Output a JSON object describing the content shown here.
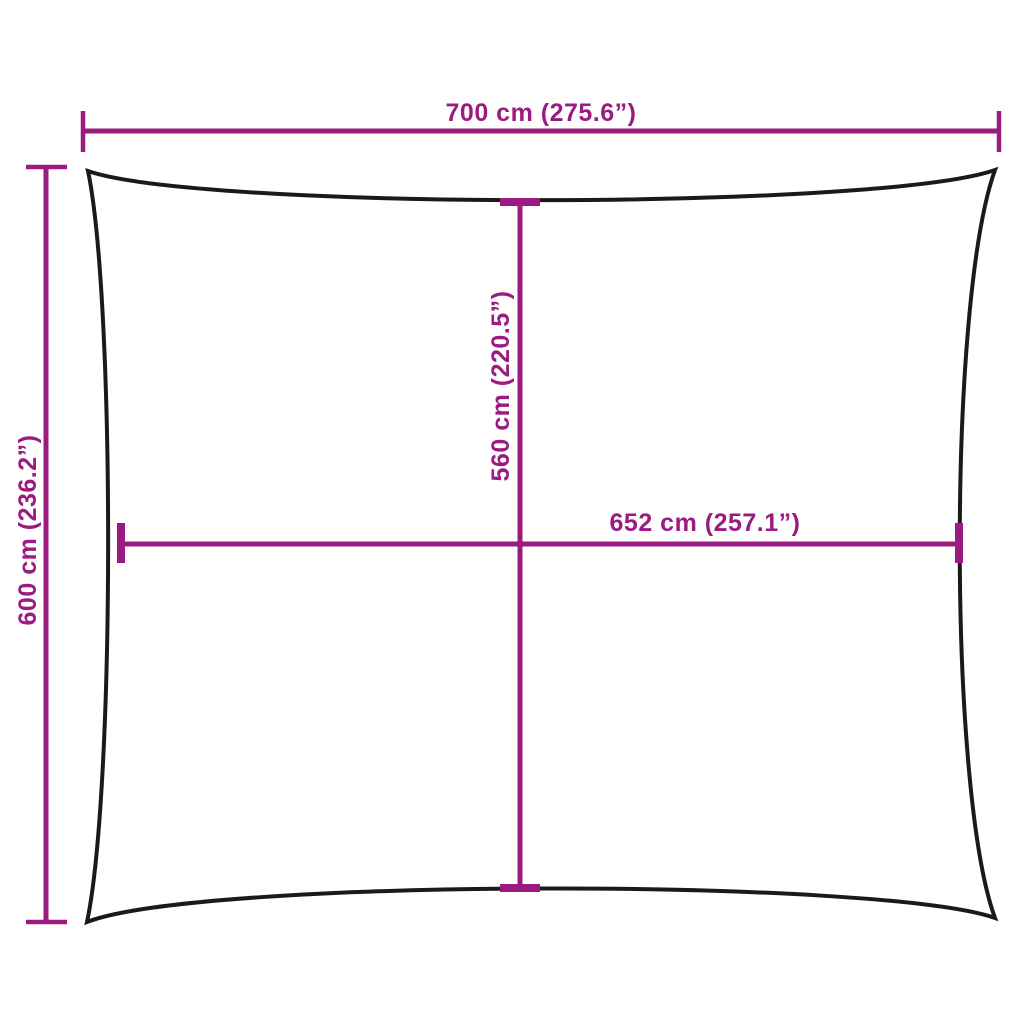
{
  "diagram": {
    "type": "shade-sail-dimension-diagram",
    "colors": {
      "dimension_accent": "#9B1B80",
      "sail_outline": "#1A1A1A",
      "background": "#FFFFFF"
    },
    "labels": {
      "top_width": "700 cm (275.6”)",
      "left_height": "600 cm (236.2”)",
      "center_height": "560 cm (220.5”)",
      "center_width": "652 cm (257.1”)"
    }
  }
}
